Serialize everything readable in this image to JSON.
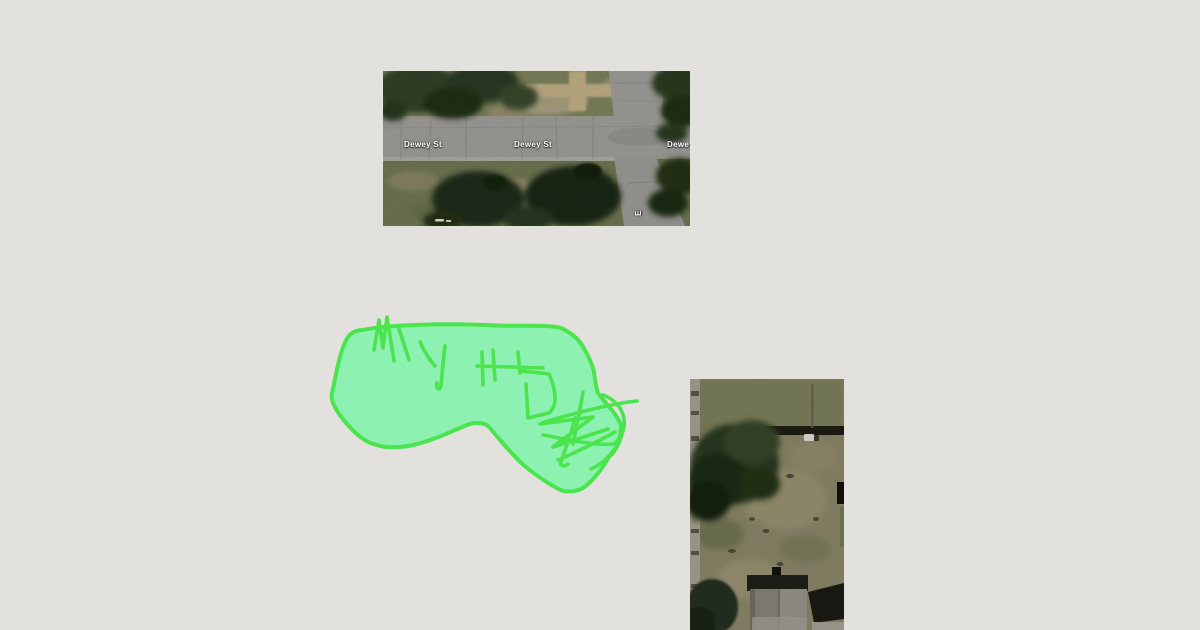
{
  "colors": {
    "page-bg": "#e3e1dd",
    "annotation-stroke": "#4be44e",
    "annotation-fill": "#8df1b1",
    "street-label-text": "#ffffff"
  },
  "top_map_image": {
    "kind": "aerial-satellite-photo",
    "subject": "Dewey St intersection with tree canopy and tan cross-shaped path",
    "street_labels": [
      {
        "text": "Dewey St"
      },
      {
        "text": "Dewey St"
      },
      {
        "text": "Dewey St"
      },
      {
        "text": "E"
      }
    ]
  },
  "annotation_drawing": {
    "kind": "freehand-highlighter-blob-with-scribbles"
  },
  "bottom_map_image": {
    "kind": "aerial-satellite-photo",
    "subject": "Backyard lawn with large tree, fence shadow and house rooftops",
    "street_labels": []
  }
}
